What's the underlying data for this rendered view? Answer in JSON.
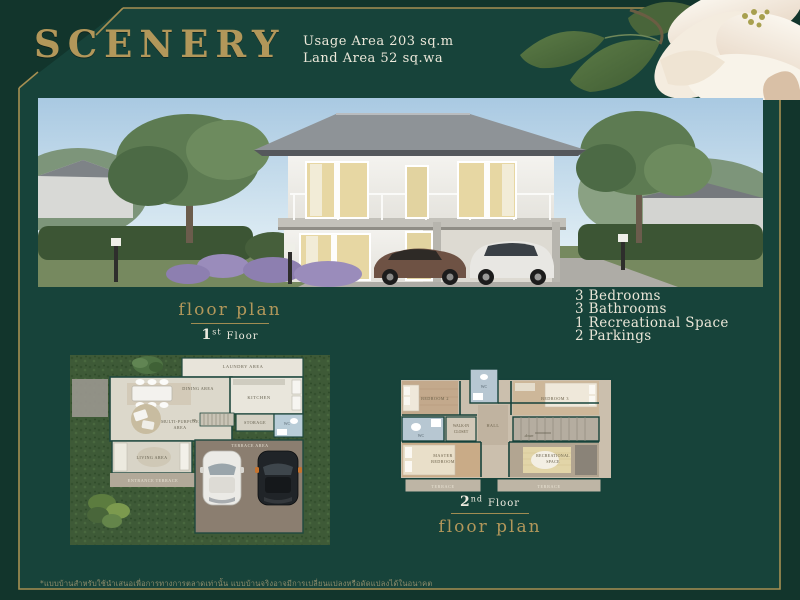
{
  "header": {
    "title": "SCENERY",
    "usage_area": "Usage Area 203 sq.m",
    "land_area": "Land Area 52 sq.wa"
  },
  "amenities": {
    "items": [
      "3 Bedrooms",
      "3 Bathrooms",
      "1 Recreational Space",
      "2 Parkings"
    ],
    "item0": "3 Bedrooms",
    "item1": "3 Bathrooms",
    "item2": "1 Recreational Space",
    "item3": "2 Parkings"
  },
  "floorplan1": {
    "caption": "floor plan",
    "floor_num": "1",
    "floor_suffix": "st",
    "floor_word": "Floor",
    "rooms": {
      "laundry": "LAUNDRY AREA",
      "dining": "DINING AREA",
      "kitchen": "KITCHEN",
      "storage": "STORAGE",
      "wc": "WC",
      "up": "up",
      "multipurpose_1": "MULTI-PURPOSE",
      "multipurpose_2": "AREA",
      "living": "LIVING AREA",
      "entrance": "ENTRANCE TERRACE",
      "terrace": "TERRACE AREA"
    }
  },
  "floorplan2": {
    "caption": "floor plan",
    "floor_num": "2",
    "floor_suffix": "nd",
    "floor_word": "Floor",
    "rooms": {
      "bedroom2": "BEDROOM 2",
      "wc_top": "WC",
      "bedroom3": "BEDROOM 3",
      "wc_left": "WC",
      "walkin_1": "WALK-IN",
      "walkin_2": "CLOSET",
      "hall": "HALL",
      "down": "down",
      "master_1": "MASTER",
      "master_2": "BEDROOM",
      "rec_1": "RECREATIONAL",
      "rec_2": "SPACE",
      "terrace_left": "TERRACE",
      "terrace_right": "TERRACE"
    }
  },
  "footer": {
    "disclaimer": "*แบบบ้านสำหรับใช้นำเสนอเพื่อการทางการตลาดเท่านั้น แบบบ้านจริงอาจมีการเปลี่ยนแปลงหรือดัดแปลงได้ในอนาคต"
  },
  "colors": {
    "background_outer": "#12352c",
    "background_inner": "#17433a",
    "frame_gold": "#a68f52",
    "title_gold": "#b2975a",
    "text_cream": "#ece8da"
  }
}
